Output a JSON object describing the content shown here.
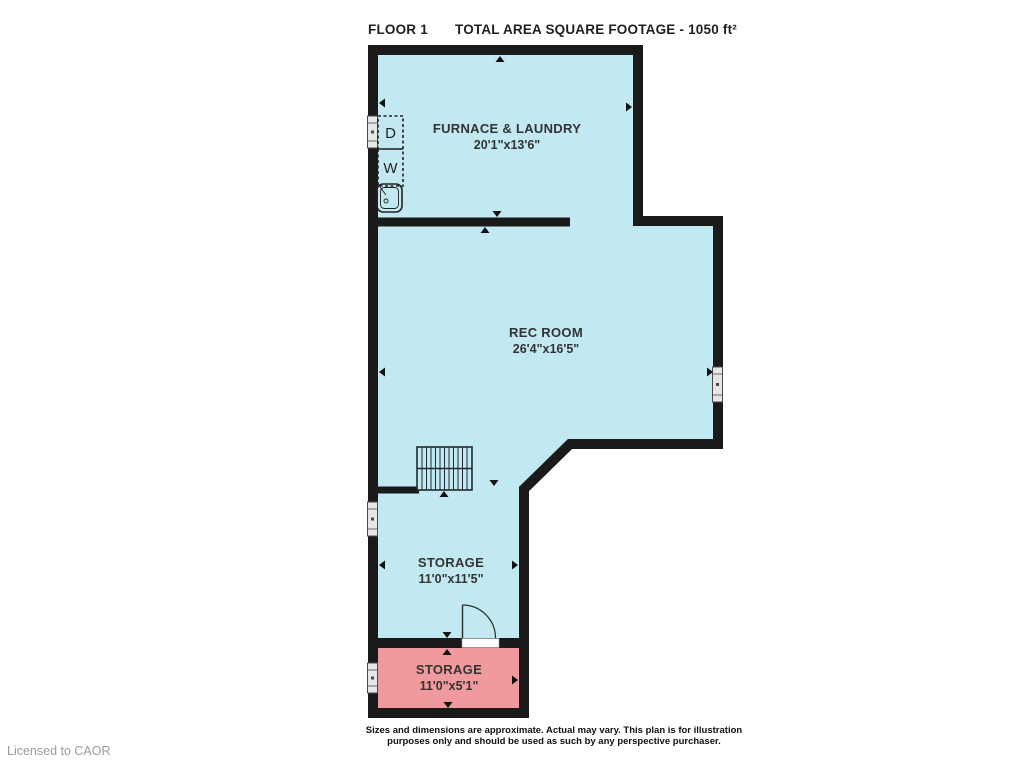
{
  "header": {
    "floor_label": "FLOOR 1",
    "total_area_label": "TOTAL AREA SQUARE FOOTAGE - 1050 ft²"
  },
  "rooms": [
    {
      "name": "FURNACE & LAUNDRY",
      "dimensions": "20'1\"x13'6\""
    },
    {
      "name": "REC ROOM",
      "dimensions": "26'4\"x16'5\""
    },
    {
      "name": "STORAGE",
      "dimensions": "11'0\"x11'5\""
    },
    {
      "name": "STORAGE",
      "dimensions": "11'0\"x5'1\""
    }
  ],
  "fixtures": {
    "dryer_label": "D",
    "washer_label": "W"
  },
  "footer": {
    "disclaimer_line1": "Sizes and dimensions are approximate. Actual may vary. This plan is for illustration",
    "disclaimer_line2": "purposes only and should be used as such by any perspective purchaser.",
    "license": "Licensed to CAOR"
  },
  "colors": {
    "room_fill": "#c2e8f2",
    "storage_accent_fill": "#f09a9d",
    "wall": "#1a1a1a"
  }
}
